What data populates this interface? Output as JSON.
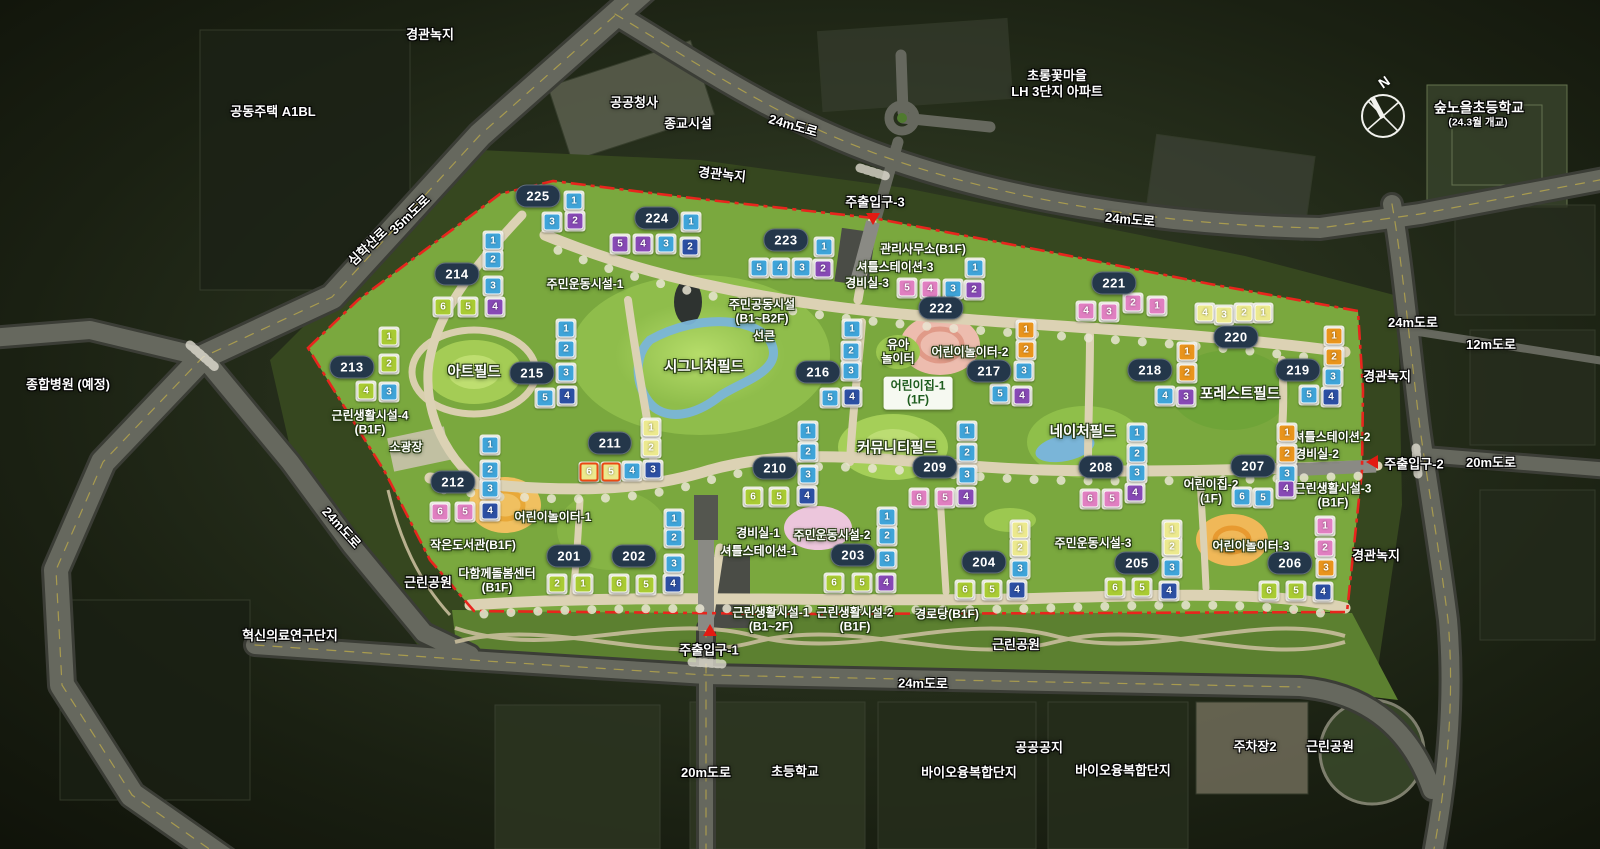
{
  "compass": {
    "label": "N",
    "x": 1383,
    "y": 116
  },
  "colors": {
    "site_green": "#7aa83e",
    "boundary_red": "#e8251d",
    "badge_bg": "#24374a",
    "road_gray": "#66685e",
    "path_beige": "#dcd2b4",
    "water_blue": "#7ab5d8",
    "unit_colors": {
      "blue": "#3fa4d9",
      "darkblue": "#2c4fa3",
      "purple": "#8749b5",
      "pink": "#e07fc1",
      "orange": "#e9941c",
      "green": "#a9cb33",
      "yellow": "#ece98e"
    }
  },
  "area_labels": [
    {
      "text": "경관녹지",
      "x": 430,
      "y": 35
    },
    {
      "text": "공동주택 A1BL",
      "x": 273,
      "y": 112
    },
    {
      "text": "공공청사",
      "x": 634,
      "y": 103
    },
    {
      "text": "종교시설",
      "x": 688,
      "y": 124
    },
    {
      "text": "24m도로",
      "x": 793,
      "y": 126,
      "rot": 16
    },
    {
      "text": "초롱꽃마을\nLH 3단지 아파트",
      "x": 1057,
      "y": 84
    },
    {
      "text": "숲노을초등학교",
      "x": 1479,
      "y": 108,
      "size": 14
    },
    {
      "text": "(24.3월 개교)",
      "x": 1478,
      "y": 123,
      "size": 10.5
    },
    {
      "text": "경관녹지",
      "x": 722,
      "y": 175,
      "rot": 6
    },
    {
      "text": "35m도로",
      "x": 410,
      "y": 215,
      "rot": -44
    },
    {
      "text": "심학산로",
      "x": 368,
      "y": 247,
      "rot": -44
    },
    {
      "text": "24m도로",
      "x": 1130,
      "y": 220,
      "rot": 5
    },
    {
      "text": "종합병원 (예정)",
      "x": 68,
      "y": 385
    },
    {
      "text": "24m도로",
      "x": 1413,
      "y": 323
    },
    {
      "text": "12m도로",
      "x": 1491,
      "y": 345
    },
    {
      "text": "경관녹지",
      "x": 1387,
      "y": 377
    },
    {
      "text": "20m도로",
      "x": 1491,
      "y": 463
    },
    {
      "text": "경관녹지",
      "x": 1376,
      "y": 556
    },
    {
      "text": "24m도로",
      "x": 341,
      "y": 528,
      "rot": 48
    },
    {
      "text": "근린공원",
      "x": 428,
      "y": 583
    },
    {
      "text": "혁신의료연구단지",
      "x": 290,
      "y": 636
    },
    {
      "text": "근린공원",
      "x": 1016,
      "y": 645
    },
    {
      "text": "24m도로",
      "x": 923,
      "y": 684,
      "rot": 1
    },
    {
      "text": "20m도로",
      "x": 706,
      "y": 773
    },
    {
      "text": "초등학교",
      "x": 795,
      "y": 772
    },
    {
      "text": "바이오융복합단지",
      "x": 969,
      "y": 773
    },
    {
      "text": "공공공지",
      "x": 1039,
      "y": 748
    },
    {
      "text": "바이오융복합단지",
      "x": 1123,
      "y": 771
    },
    {
      "text": "주차장2",
      "x": 1255,
      "y": 747
    },
    {
      "text": "근린공원",
      "x": 1330,
      "y": 747
    }
  ],
  "facility_labels": [
    {
      "text": "주민운동시설-1",
      "x": 585,
      "y": 284
    },
    {
      "text": "주민공동시설\n(B1~B2F)",
      "x": 762,
      "y": 312
    },
    {
      "text": "선큰",
      "x": 764,
      "y": 336
    },
    {
      "text": "시그니처필드",
      "x": 704,
      "y": 368,
      "big": true
    },
    {
      "text": "아트필드",
      "x": 474,
      "y": 373,
      "big": true
    },
    {
      "text": "근린생활시설-4\n(B1F)",
      "x": 370,
      "y": 423
    },
    {
      "text": "소광장",
      "x": 406,
      "y": 447
    },
    {
      "text": "어린이놀이터-1",
      "x": 553,
      "y": 517
    },
    {
      "text": "작은도서관(B1F)",
      "x": 473,
      "y": 545
    },
    {
      "text": "다함께돌봄센터\n(B1F)",
      "x": 497,
      "y": 581
    },
    {
      "text": "관리사무소(B1F)",
      "x": 923,
      "y": 249
    },
    {
      "text": "셔틀스테이션-3",
      "x": 895,
      "y": 267
    },
    {
      "text": "경비실-3",
      "x": 867,
      "y": 283
    },
    {
      "text": "유아\n놀이터",
      "x": 898,
      "y": 352
    },
    {
      "text": "어린이놀이터-2",
      "x": 970,
      "y": 352
    },
    {
      "text": "어린이집-1\n(1F)",
      "x": 918,
      "y": 393,
      "boxed": true
    },
    {
      "text": "커뮤니티필드",
      "x": 897,
      "y": 449,
      "big": true
    },
    {
      "text": "네이처필드",
      "x": 1083,
      "y": 433,
      "big": true
    },
    {
      "text": "포레스트필드",
      "x": 1240,
      "y": 395,
      "big": true
    },
    {
      "text": "셔틀스테이션-2",
      "x": 1332,
      "y": 437
    },
    {
      "text": "경비실-2",
      "x": 1317,
      "y": 454
    },
    {
      "text": "어린이집-2\n(1F)",
      "x": 1211,
      "y": 492
    },
    {
      "text": "근린생활시설-3\n(B1F)",
      "x": 1333,
      "y": 496
    },
    {
      "text": "경비실-1",
      "x": 758,
      "y": 533
    },
    {
      "text": "셔틀스테이션-1",
      "x": 759,
      "y": 551
    },
    {
      "text": "주민운동시설-2",
      "x": 832,
      "y": 535
    },
    {
      "text": "주민운동시설-3",
      "x": 1093,
      "y": 543
    },
    {
      "text": "어린이놀이터-3",
      "x": 1251,
      "y": 546
    },
    {
      "text": "근린생활시설-1\n(B1~2F)",
      "x": 771,
      "y": 620
    },
    {
      "text": "근린생활시설-2\n(B1F)",
      "x": 855,
      "y": 620
    },
    {
      "text": "경로당(B1F)",
      "x": 947,
      "y": 614
    }
  ],
  "entrances": [
    {
      "label": "주출입구-1",
      "lx": 709,
      "ly": 649,
      "arrow": "up",
      "ax": 710,
      "ay": 630
    },
    {
      "label": "주출입구-2",
      "lx": 1414,
      "ly": 463,
      "arrow": "left",
      "ax": 1372,
      "ay": 462
    },
    {
      "label": "주출입구-3",
      "lx": 875,
      "ly": 201,
      "arrow": "down",
      "ax": 873,
      "ay": 219
    }
  ],
  "buildings": [
    {
      "id": "201",
      "badge": [
        569,
        556
      ],
      "units": [
        [
          "2",
          "green",
          557,
          584
        ],
        [
          "1",
          "green",
          583,
          584
        ]
      ]
    },
    {
      "id": "202",
      "badge": [
        634,
        556
      ],
      "units": [
        [
          "1",
          "blue",
          674,
          519
        ],
        [
          "2",
          "blue",
          674,
          538
        ],
        [
          "3",
          "blue",
          674,
          564
        ],
        [
          "6",
          "green",
          619,
          584
        ],
        [
          "5",
          "green",
          646,
          585
        ],
        [
          "4",
          "darkblue",
          673,
          584
        ]
      ]
    },
    {
      "id": "203",
      "badge": [
        853,
        555
      ],
      "units": [
        [
          "1",
          "blue",
          887,
          517
        ],
        [
          "2",
          "blue",
          887,
          536
        ],
        [
          "3",
          "blue",
          887,
          559
        ],
        [
          "6",
          "green",
          834,
          583
        ],
        [
          "5",
          "green",
          862,
          583
        ],
        [
          "4",
          "purple",
          886,
          583
        ]
      ]
    },
    {
      "id": "204",
      "badge": [
        984,
        562
      ],
      "units": [
        [
          "1",
          "yellow",
          1020,
          530
        ],
        [
          "2",
          "yellow",
          1020,
          548
        ],
        [
          "3",
          "blue",
          1020,
          569
        ],
        [
          "6",
          "green",
          965,
          590
        ],
        [
          "5",
          "green",
          992,
          590
        ],
        [
          "4",
          "darkblue",
          1017,
          590
        ]
      ]
    },
    {
      "id": "205",
      "badge": [
        1137,
        563
      ],
      "units": [
        [
          "1",
          "yellow",
          1172,
          530
        ],
        [
          "2",
          "yellow",
          1172,
          547
        ],
        [
          "3",
          "blue",
          1172,
          568
        ],
        [
          "6",
          "green",
          1115,
          588
        ],
        [
          "5",
          "green",
          1142,
          588
        ],
        [
          "4",
          "darkblue",
          1169,
          591
        ]
      ]
    },
    {
      "id": "206",
      "badge": [
        1290,
        563
      ],
      "units": [
        [
          "1",
          "pink",
          1325,
          526
        ],
        [
          "2",
          "pink",
          1325,
          548
        ],
        [
          "3",
          "orange",
          1326,
          568
        ],
        [
          "6",
          "green",
          1269,
          591
        ],
        [
          "5",
          "green",
          1296,
          591
        ],
        [
          "4",
          "darkblue",
          1323,
          592
        ]
      ]
    },
    {
      "id": "207",
      "badge": [
        1253,
        466
      ],
      "units": [
        [
          "1",
          "orange",
          1287,
          433
        ],
        [
          "2",
          "orange",
          1287,
          454
        ],
        [
          "3",
          "blue",
          1287,
          474
        ],
        [
          "6",
          "blue",
          1242,
          497
        ],
        [
          "5",
          "blue",
          1263,
          498
        ],
        [
          "4",
          "purple",
          1286,
          489
        ]
      ]
    },
    {
      "id": "208",
      "badge": [
        1101,
        467
      ],
      "units": [
        [
          "1",
          "blue",
          1137,
          433
        ],
        [
          "2",
          "blue",
          1137,
          454
        ],
        [
          "3",
          "blue",
          1137,
          473
        ],
        [
          "6",
          "pink",
          1090,
          499
        ],
        [
          "5",
          "pink",
          1112,
          499
        ],
        [
          "4",
          "purple",
          1135,
          493
        ]
      ]
    },
    {
      "id": "209",
      "badge": [
        935,
        467
      ],
      "units": [
        [
          "1",
          "blue",
          967,
          431
        ],
        [
          "2",
          "blue",
          967,
          453
        ],
        [
          "3",
          "blue",
          967,
          475
        ],
        [
          "6",
          "pink",
          919,
          498
        ],
        [
          "5",
          "pink",
          945,
          498
        ],
        [
          "4",
          "purple",
          966,
          497
        ]
      ]
    },
    {
      "id": "210",
      "badge": [
        775,
        468
      ],
      "units": [
        [
          "1",
          "blue",
          808,
          431
        ],
        [
          "2",
          "blue",
          808,
          452
        ],
        [
          "3",
          "blue",
          808,
          475
        ],
        [
          "6",
          "green",
          753,
          497
        ],
        [
          "5",
          "green",
          779,
          497
        ],
        [
          "4",
          "darkblue",
          807,
          496
        ]
      ]
    },
    {
      "id": "211",
      "badge": [
        610,
        443
      ],
      "units": [
        [
          "1",
          "yellow",
          651,
          428
        ],
        [
          "2",
          "yellow",
          651,
          448
        ],
        [
          "6",
          "yellow",
          589,
          472,
          1
        ],
        [
          "5",
          "yellow",
          611,
          472,
          1
        ],
        [
          "4",
          "blue",
          632,
          471
        ],
        [
          "3",
          "darkblue",
          653,
          470
        ]
      ]
    },
    {
      "id": "212",
      "badge": [
        453,
        482
      ],
      "units": [
        [
          "1",
          "blue",
          490,
          445
        ],
        [
          "2",
          "blue",
          490,
          470
        ],
        [
          "3",
          "blue",
          490,
          489
        ],
        [
          "6",
          "pink",
          440,
          512
        ],
        [
          "5",
          "pink",
          465,
          512
        ],
        [
          "4",
          "darkblue",
          490,
          511
        ]
      ]
    },
    {
      "id": "213",
      "badge": [
        352,
        367
      ],
      "units": [
        [
          "1",
          "green",
          389,
          337
        ],
        [
          "2",
          "green",
          389,
          364
        ],
        [
          "4",
          "green",
          366,
          391
        ],
        [
          "3",
          "blue",
          389,
          392
        ]
      ]
    },
    {
      "id": "214",
      "badge": [
        457,
        274
      ],
      "units": [
        [
          "1",
          "blue",
          493,
          241
        ],
        [
          "2",
          "blue",
          493,
          260
        ],
        [
          "3",
          "blue",
          493,
          286
        ],
        [
          "6",
          "green",
          443,
          307
        ],
        [
          "5",
          "green",
          468,
          307
        ],
        [
          "4",
          "purple",
          495,
          307
        ]
      ]
    },
    {
      "id": "215",
      "badge": [
        532,
        373
      ],
      "units": [
        [
          "1",
          "blue",
          566,
          329
        ],
        [
          "2",
          "blue",
          566,
          349
        ],
        [
          "3",
          "blue",
          566,
          373
        ],
        [
          "5",
          "blue",
          545,
          398
        ],
        [
          "4",
          "darkblue",
          567,
          396
        ]
      ]
    },
    {
      "id": "216",
      "badge": [
        818,
        372
      ],
      "units": [
        [
          "1",
          "blue",
          852,
          329
        ],
        [
          "2",
          "blue",
          851,
          351
        ],
        [
          "3",
          "blue",
          851,
          371
        ],
        [
          "5",
          "blue",
          830,
          398
        ],
        [
          "4",
          "darkblue",
          852,
          397
        ]
      ]
    },
    {
      "id": "217",
      "badge": [
        989,
        371
      ],
      "units": [
        [
          "1",
          "orange",
          1026,
          330
        ],
        [
          "2",
          "orange",
          1026,
          350
        ],
        [
          "3",
          "blue",
          1024,
          371
        ],
        [
          "5",
          "blue",
          1000,
          394
        ],
        [
          "4",
          "purple",
          1022,
          396
        ]
      ]
    },
    {
      "id": "218",
      "badge": [
        1150,
        370
      ],
      "units": [
        [
          "1",
          "orange",
          1187,
          352
        ],
        [
          "2",
          "orange",
          1187,
          373
        ],
        [
          "4",
          "blue",
          1165,
          396
        ],
        [
          "3",
          "purple",
          1186,
          397
        ]
      ]
    },
    {
      "id": "219",
      "badge": [
        1298,
        370
      ],
      "units": [
        [
          "1",
          "orange",
          1334,
          336
        ],
        [
          "2",
          "orange",
          1334,
          357
        ],
        [
          "3",
          "blue",
          1333,
          377
        ],
        [
          "5",
          "blue",
          1309,
          395
        ],
        [
          "4",
          "darkblue",
          1331,
          397
        ]
      ]
    },
    {
      "id": "220",
      "badge": [
        1236,
        337
      ],
      "units": [
        [
          "4",
          "yellow",
          1205,
          313
        ],
        [
          "3",
          "yellow",
          1224,
          315
        ],
        [
          "2",
          "yellow",
          1244,
          313
        ],
        [
          "1",
          "yellow",
          1263,
          313
        ]
      ]
    },
    {
      "id": "221",
      "badge": [
        1114,
        283
      ],
      "units": [
        [
          "4",
          "pink",
          1086,
          311
        ],
        [
          "3",
          "pink",
          1109,
          312
        ],
        [
          "2",
          "pink",
          1133,
          303
        ],
        [
          "1",
          "pink",
          1157,
          306
        ]
      ]
    },
    {
      "id": "222",
      "badge": [
        941,
        308
      ],
      "units": [
        [
          "1",
          "blue",
          975,
          268
        ],
        [
          "5",
          "pink",
          907,
          288
        ],
        [
          "4",
          "pink",
          930,
          289
        ],
        [
          "3",
          "blue",
          953,
          289
        ],
        [
          "2",
          "purple",
          974,
          290
        ]
      ]
    },
    {
      "id": "223",
      "badge": [
        786,
        240
      ],
      "units": [
        [
          "1",
          "blue",
          824,
          247
        ],
        [
          "5",
          "blue",
          759,
          268
        ],
        [
          "4",
          "blue",
          780,
          268
        ],
        [
          "3",
          "blue",
          802,
          268
        ],
        [
          "2",
          "purple",
          823,
          269
        ]
      ]
    },
    {
      "id": "224",
      "badge": [
        657,
        218
      ],
      "units": [
        [
          "1",
          "blue",
          691,
          222
        ],
        [
          "5",
          "purple",
          620,
          244
        ],
        [
          "4",
          "purple",
          643,
          244
        ],
        [
          "3",
          "blue",
          666,
          244
        ],
        [
          "2",
          "darkblue",
          690,
          247
        ]
      ]
    },
    {
      "id": "225",
      "badge": [
        538,
        196
      ],
      "units": [
        [
          "1",
          "blue",
          574,
          201
        ],
        [
          "3",
          "blue",
          552,
          222
        ],
        [
          "2",
          "purple",
          575,
          221
        ]
      ]
    }
  ]
}
